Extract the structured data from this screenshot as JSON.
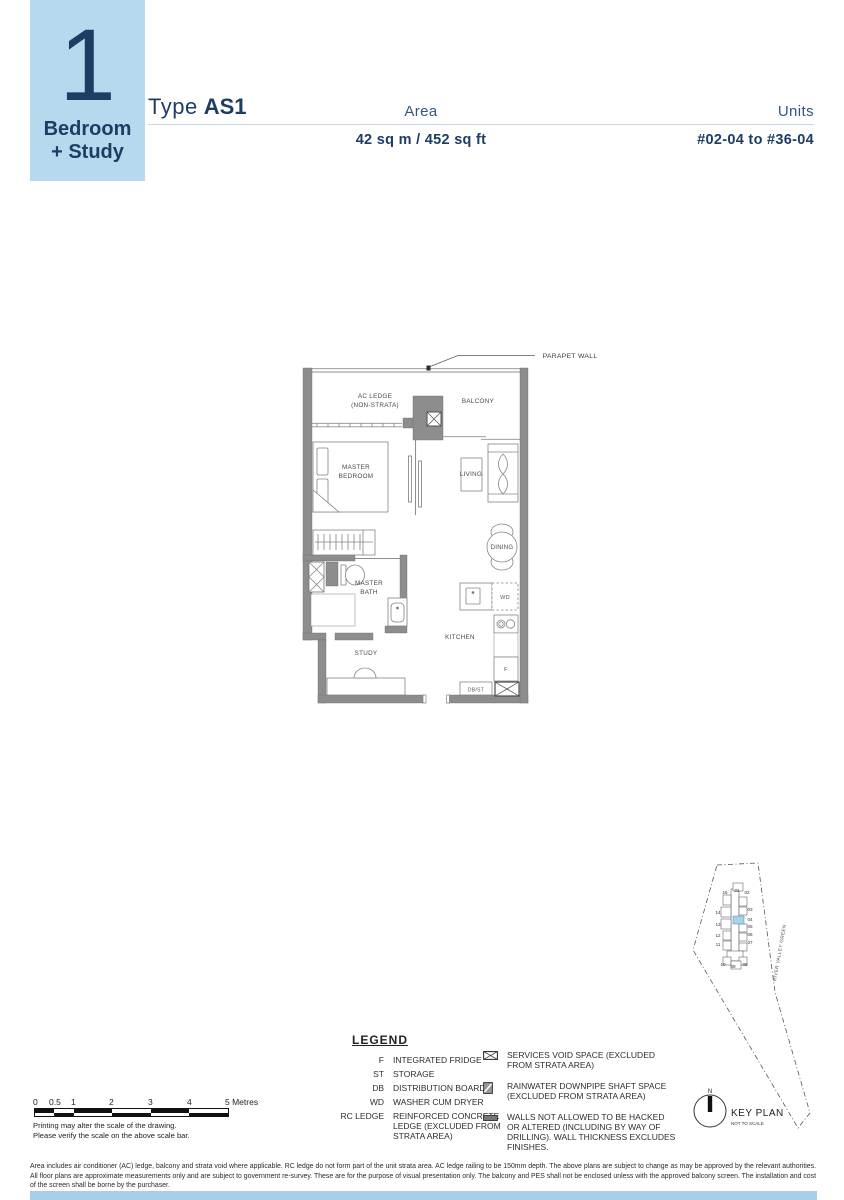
{
  "header": {
    "big_number": "1",
    "unit_type_line1": "Bedroom",
    "unit_type_line2": "+ Study",
    "type_prefix": "Type",
    "type_value": "AS1",
    "area_label": "Area",
    "area_value": "42 sq m / 452 sq ft",
    "units_label": "Units",
    "units_value": "#02-04 to #36-04"
  },
  "colors": {
    "accent_blue": "#b7d9ee",
    "navy": "#1e3d64",
    "wall_gray": "#8d8d8d",
    "keyplan_highlight": "#a9d3ea",
    "bottom_bar": "#a8cee8"
  },
  "floorplan": {
    "labels": {
      "parapet": "PARAPET WALL",
      "ac_ledge_1": "AC LEDGE",
      "ac_ledge_2": "(NON-STRATA)",
      "balcony": "BALCONY",
      "master_bedroom_1": "MASTER",
      "master_bedroom_2": "BEDROOM",
      "living": "LIVING",
      "dining": "DINING",
      "master_bath_1": "MASTER",
      "master_bath_2": "BATH",
      "study": "STUDY",
      "kitchen": "KITCHEN",
      "wd": "WD",
      "fridge": "F",
      "dbst": "DB/ST"
    }
  },
  "legend": {
    "title": "LEGEND",
    "items": [
      {
        "abbr": "F",
        "desc": "INTEGRATED FRIDGE"
      },
      {
        "abbr": "ST",
        "desc": "STORAGE"
      },
      {
        "abbr": "DB",
        "desc": "DISTRIBUTION BOARD"
      },
      {
        "abbr": "WD",
        "desc": "WASHER CUM DRYER"
      },
      {
        "abbr": "RC LEDGE",
        "desc": "REINFORCED CONCRETE LEDGE (EXCLUDED FROM STRATA AREA)"
      }
    ],
    "symbol_items": [
      {
        "icon": "services-void",
        "desc": "SERVICES VOID SPACE (EXCLUDED FROM STRATA AREA)"
      },
      {
        "icon": "rainwater-downpipe",
        "desc": "RAINWATER DOWNPIPE SHAFT SPACE (EXCLUDED FROM STRATA AREA)"
      },
      {
        "icon": "wall-no-hack",
        "desc": "WALLS NOT ALLOWED TO BE HACKED OR ALTERED (INCLUDING BY WAY OF DRILLING). WALL THICKNESS EXCLUDES FINISHES."
      }
    ]
  },
  "scalebar": {
    "ticks": [
      "0",
      "0.5",
      "1",
      "2",
      "3",
      "4",
      "5 Metres"
    ],
    "note1": "Printing may alter the scale of the drawing.",
    "note2": "Please verify the scale on the above scale bar."
  },
  "keyplan": {
    "title": "KEY PLAN",
    "subtitle": "NOT TO SCALE",
    "north": "N",
    "street": "RIVER VALLEY GREEN",
    "highlighted_unit": "04",
    "units": [
      "15",
      "01",
      "02",
      "14",
      "03",
      "13",
      "04",
      "05",
      "12",
      "06",
      "11",
      "07",
      "10",
      "09",
      "08"
    ]
  },
  "disclaimer": {
    "text": "Area includes air conditioner (AC) ledge, balcony and strata void where applicable. RC ledge do not form part of the unit strata area. AC ledge railing to be 150mm depth. The above plans are subject to change as may be approved by the relevant authorities. All floor plans are approximate measurements only and are subject to government re-survey. These are for the purpose of visual presentation only. The balcony and PES shall not be enclosed unless with the approved balcony screen. The installation and cost of the screen shall be borne by the purchaser."
  }
}
